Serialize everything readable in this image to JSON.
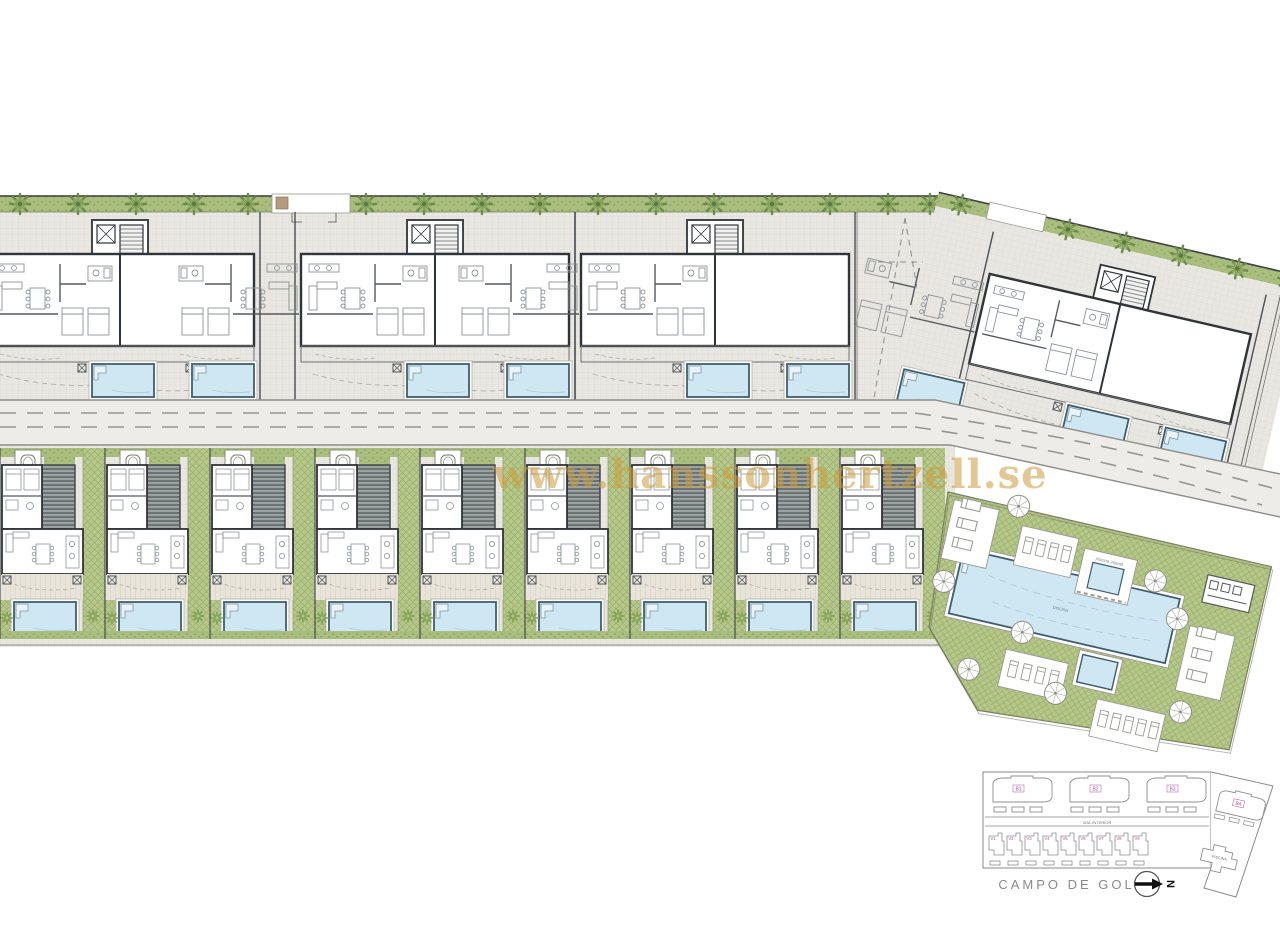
{
  "watermark": {
    "text": "www.hanssonhertzell.se",
    "color": "#cd9c3c"
  },
  "keyplan": {
    "golf_label": "CAMPO DE GOLF",
    "north_letter": "N",
    "street_label": "VIAL INTERIOR",
    "piscina_label": "PISCINA",
    "blocks": [
      "B1",
      "B2",
      "B3"
    ],
    "block4": "B4",
    "villas": [
      "V1",
      "V2",
      "V3",
      "V4",
      "V5",
      "V6",
      "V7",
      "V8",
      "V9"
    ],
    "label_color": "#b0509a"
  },
  "communal": {
    "kids_pool_label": "piscina infantil",
    "main_pool_label": "piscina"
  },
  "colors": {
    "hedge_green": "#a9bd7e",
    "tree_green": "#6b8c49",
    "lawn_green": "#b6c78c",
    "pool_blue": "#cfe6f3",
    "pool_edge": "#3f5e6c",
    "paving": "#e9e7e2",
    "road": "#eeece8",
    "wall_dark": "#2f3438",
    "keyplan_pink": "#b0509a"
  }
}
